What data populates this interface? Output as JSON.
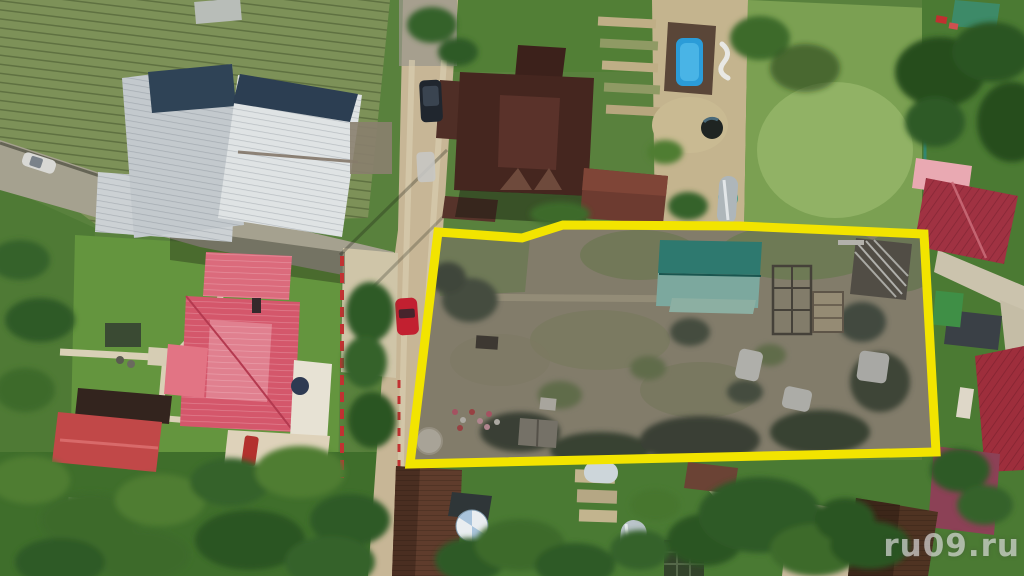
{
  "watermark": {
    "text": "ru09.ru"
  },
  "highlight": {
    "name": "property-plot-boundary",
    "border_color": "#f2e400",
    "interior_dim": "rgba(58,58,62,0.26)"
  },
  "palette": {
    "dirt_road": "#c7b696",
    "asphalt_road": "#a5a18f",
    "lawn_green": "#64953e",
    "crop_field": "#7d9158",
    "plot_dry_grass": "#9b937a",
    "metal_roof_light": "#dfe3e4",
    "metal_roof_navy": "#2c3e52",
    "brown_hip_roof": "#45261f",
    "pink_roof": "#d4576b",
    "small_red_roof": "#c14848",
    "crimson_roof": "#a03242",
    "teal_barn_roof": "#2a8f80",
    "pool_water": "#2b9cd8",
    "maroon_canopy": "#8c4156",
    "brown_shingle_roof": "#5f3c2c"
  },
  "objects": [
    "highlighted land plot outlined in yellow",
    "teal gable-roof barn inside plot",
    "white greenhouse tunnels inside plot",
    "wooden garden-bed frames inside plot",
    "lumber rack inside plot",
    "pale round well cover inside plot",
    "flower bed inside plot",
    "corrugated metal warehouse roofs",
    "crop field with planted rows",
    "dark brown hip-roof house",
    "brown outbuilding",
    "dark van parked on road",
    "red car parked on road",
    "white car on left road",
    "swimming pool with dark deck",
    "water barrel and silver tank",
    "pink hip-roof house with lawn and paths",
    "red picket fence line",
    "small red-roof outbuilding",
    "central dirt road",
    "left asphalt road",
    "crimson-roof houses on right",
    "maroon canopy structure",
    "brown shingle-roof houses",
    "round garden umbrella",
    "arched greenhouses and garden beds",
    "watermark"
  ]
}
